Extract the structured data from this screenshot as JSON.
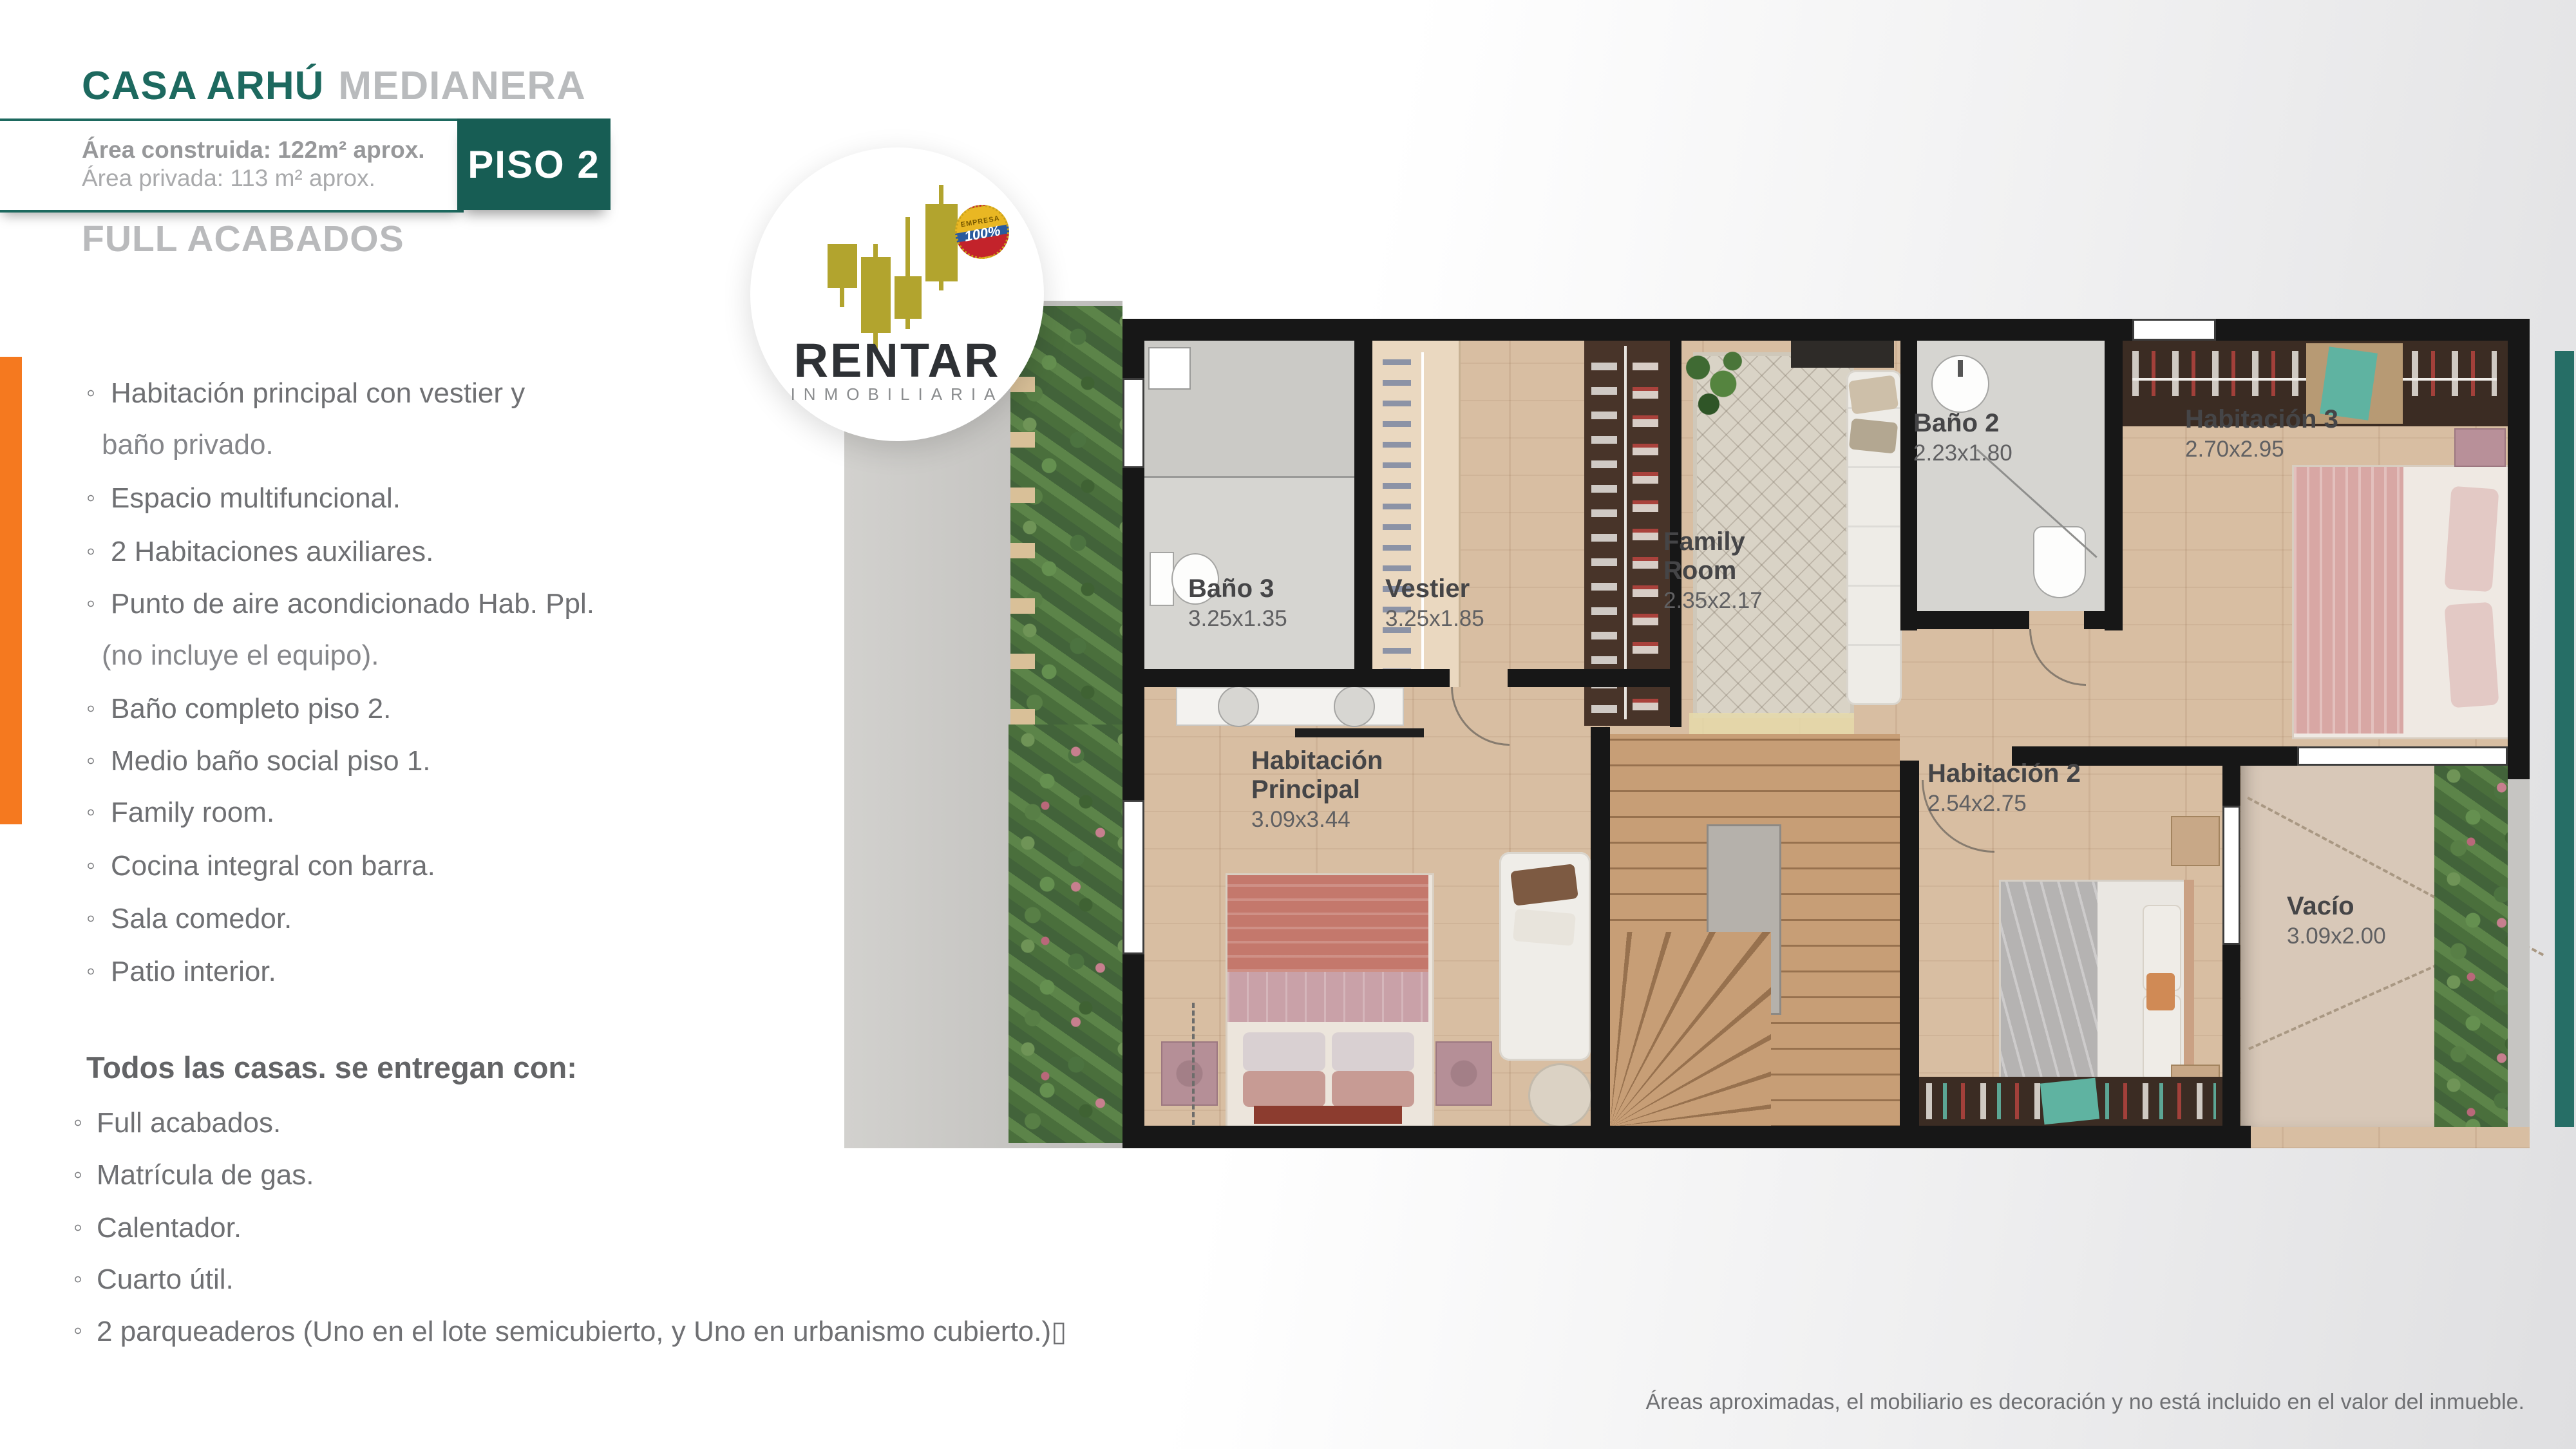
{
  "header": {
    "title": "CASA ARHÚ",
    "subtitle": "MEDIANERA",
    "area_line1": "Área construida: 122m² aprox.",
    "area_line2": "Área privada: 113 m² aprox.",
    "floor_badge": "PISO 2",
    "finish_label": "FULL ACABADOS"
  },
  "logo": {
    "brand": "RENTAR",
    "tagline": "INMOBILIARIA",
    "badge_line1": "EMPRESA",
    "badge_line2": "100%"
  },
  "features": {
    "items": [
      {
        "text": "Habitación principal con vestier y",
        "text2": "baño privado."
      },
      {
        "text": "Espacio multifuncional."
      },
      {
        "text": "2 Habitaciones auxiliares."
      },
      {
        "text": "Punto de aire acondicionado Hab. Ppl.",
        "text2": "(no incluye el equipo)."
      },
      {
        "text": "Baño completo piso 2."
      },
      {
        "text": "Medio baño social piso 1."
      },
      {
        "text": "Family room."
      },
      {
        "text": "Cocina integral con barra."
      },
      {
        "text": "Sala comedor."
      },
      {
        "text": "Patio interior."
      }
    ]
  },
  "delivery": {
    "heading": "Todos las casas. se entregan con:",
    "items": [
      {
        "text": "Full acabados."
      },
      {
        "text": "Matrícula de gas."
      },
      {
        "text": "Calentador."
      },
      {
        "text": "Cuarto útil."
      },
      {
        "text": "2 parqueaderos (Uno en el lote semicubierto, y Uno en urbanismo cubierto.)▯"
      }
    ]
  },
  "plan": {
    "rooms": [
      {
        "name": "Baño 3",
        "dims": "3.25x1.35"
      },
      {
        "name": "Vestier",
        "dims": "3.25x1.85"
      },
      {
        "name": "Family Room",
        "dims": "2.35x2.17"
      },
      {
        "name": "Baño 2",
        "dims": "2.23x1.80"
      },
      {
        "name": "Habitación 3",
        "dims": "2.70x2.95"
      },
      {
        "name": "Habitación Principal",
        "dims": "3.09x3.44"
      },
      {
        "name": "Habitación 2",
        "dims": "2.54x2.75"
      },
      {
        "name": "Vacío",
        "dims": "3.09x2.00"
      }
    ]
  },
  "footer": {
    "disclaimer": "Áreas aproximadas, el mobiliario es decoración y no está incluido en el valor del inmueble."
  },
  "colors": {
    "teal": "#1d695f",
    "orange": "#f5791f",
    "logo_olive": "#b2a42e"
  }
}
